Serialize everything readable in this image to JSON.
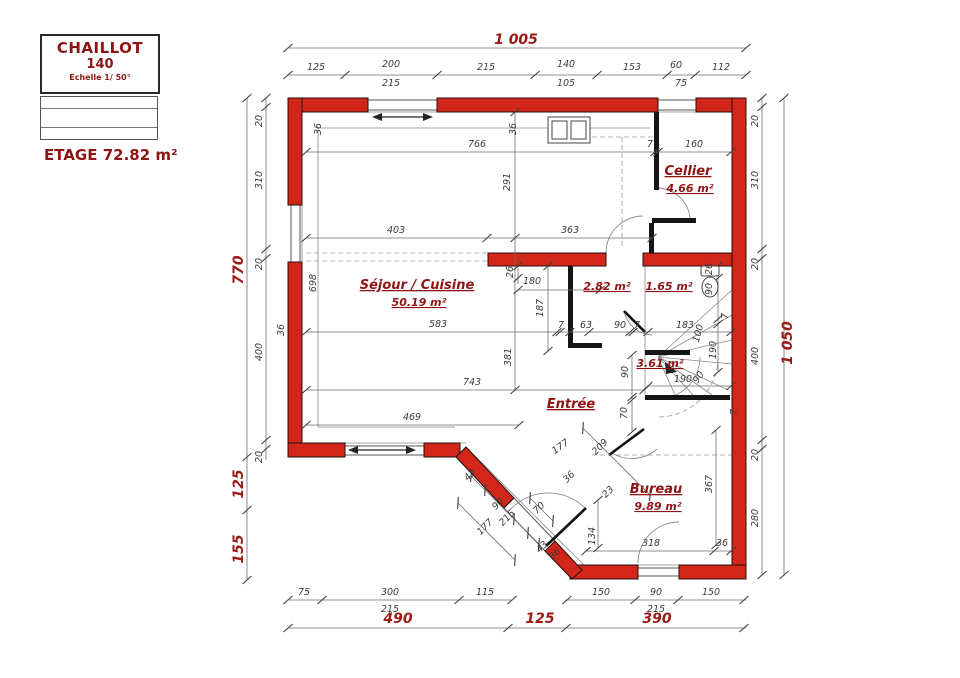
{
  "title_block": {
    "line1": "CHAILLOT",
    "line2": "140",
    "line3": "Echelle 1/ 50°"
  },
  "floor_area_label": "ETAGE 72.82 m²",
  "colors": {
    "wall_red": "#d2261a",
    "accent_text": "#8e1414",
    "dim_text": "#3a3a3a"
  },
  "rooms": [
    {
      "name": "Séjour / Cuisine",
      "area": "50.19 m²",
      "x": 417,
      "y": 289
    },
    {
      "name": "Cellier",
      "area": "4.66 m²",
      "x": 688,
      "y": 175
    },
    {
      "name": "Entrée",
      "area": "",
      "x": 571,
      "y": 408
    },
    {
      "name": "Bureau",
      "area": "9.89 m²",
      "x": 656,
      "y": 493
    },
    {
      "name": "",
      "area": "2.82 m²",
      "x": 607,
      "y": 290
    },
    {
      "name": "",
      "area": "1.65 m²",
      "x": 669,
      "y": 290
    },
    {
      "name": "",
      "area": "3.61 m²",
      "x": 660,
      "y": 367
    }
  ],
  "dimensions": {
    "overall": {
      "width": "1 005",
      "height_left": "770",
      "height_right": "1 050"
    },
    "labels": [
      {
        "t": "1 005",
        "x": 516,
        "y": 44,
        "c": "r"
      },
      {
        "t": "125",
        "x": 316,
        "y": 70
      },
      {
        "t": "200",
        "x": 391,
        "y": 67
      },
      {
        "t": "215",
        "x": 391,
        "y": 86
      },
      {
        "t": "215",
        "x": 486,
        "y": 70
      },
      {
        "t": "140",
        "x": 566,
        "y": 67
      },
      {
        "t": "105",
        "x": 566,
        "y": 86
      },
      {
        "t": "153",
        "x": 632,
        "y": 70
      },
      {
        "t": "60",
        "x": 676,
        "y": 68
      },
      {
        "t": "75",
        "x": 681,
        "y": 86
      },
      {
        "t": "112",
        "x": 721,
        "y": 70
      },
      {
        "t": "770",
        "x": 243,
        "y": 270,
        "r": -90,
        "c": "r"
      },
      {
        "t": "125",
        "x": 243,
        "y": 484,
        "r": -90,
        "c": "r"
      },
      {
        "t": "155",
        "x": 243,
        "y": 549,
        "r": -90,
        "c": "r"
      },
      {
        "t": "20",
        "x": 262,
        "y": 121,
        "r": -90
      },
      {
        "t": "310",
        "x": 262,
        "y": 180,
        "r": -90
      },
      {
        "t": "20",
        "x": 262,
        "y": 264,
        "r": -90
      },
      {
        "t": "400",
        "x": 262,
        "y": 352,
        "r": -90
      },
      {
        "t": "20",
        "x": 262,
        "y": 457,
        "r": -90
      },
      {
        "t": "20",
        "x": 758,
        "y": 121,
        "r": -90
      },
      {
        "t": "310",
        "x": 758,
        "y": 180,
        "r": -90
      },
      {
        "t": "20",
        "x": 758,
        "y": 264,
        "r": -90
      },
      {
        "t": "400",
        "x": 758,
        "y": 356,
        "r": -90
      },
      {
        "t": "20",
        "x": 758,
        "y": 455,
        "r": -90
      },
      {
        "t": "280",
        "x": 758,
        "y": 518,
        "r": -90
      },
      {
        "t": "1 050",
        "x": 792,
        "y": 343,
        "r": -90,
        "c": "r"
      },
      {
        "t": "75",
        "x": 304,
        "y": 595
      },
      {
        "t": "300",
        "x": 390,
        "y": 595
      },
      {
        "t": "215",
        "x": 390,
        "y": 612
      },
      {
        "t": "115",
        "x": 485,
        "y": 595
      },
      {
        "t": "150",
        "x": 601,
        "y": 595
      },
      {
        "t": "90",
        "x": 656,
        "y": 595
      },
      {
        "t": "215",
        "x": 656,
        "y": 612
      },
      {
        "t": "150",
        "x": 711,
        "y": 595
      },
      {
        "t": "490",
        "x": 398,
        "y": 623,
        "c": "r"
      },
      {
        "t": "125",
        "x": 540,
        "y": 623,
        "c": "r"
      },
      {
        "t": "390",
        "x": 657,
        "y": 623,
        "c": "r"
      },
      {
        "t": "36",
        "x": 321,
        "y": 129,
        "r": -90
      },
      {
        "t": "36",
        "x": 516,
        "y": 129,
        "r": -90
      },
      {
        "t": "766",
        "x": 477,
        "y": 147
      },
      {
        "t": "7",
        "x": 650,
        "y": 147
      },
      {
        "t": "160",
        "x": 694,
        "y": 147
      },
      {
        "t": "291",
        "x": 510,
        "y": 182,
        "r": -90
      },
      {
        "t": "698",
        "x": 316,
        "y": 283,
        "r": -90
      },
      {
        "t": "36",
        "x": 284,
        "y": 330,
        "r": -90
      },
      {
        "t": "403",
        "x": 396,
        "y": 233
      },
      {
        "t": "363",
        "x": 570,
        "y": 233
      },
      {
        "t": "26",
        "x": 513,
        "y": 272,
        "r": -90
      },
      {
        "t": "180",
        "x": 532,
        "y": 284
      },
      {
        "t": "187",
        "x": 543,
        "y": 308,
        "r": -90
      },
      {
        "t": "26",
        "x": 712,
        "y": 269,
        "r": -90
      },
      {
        "t": "90",
        "x": 712,
        "y": 289,
        "r": -90
      },
      {
        "t": "583",
        "x": 438,
        "y": 327
      },
      {
        "t": "7",
        "x": 561,
        "y": 328
      },
      {
        "t": "63",
        "x": 586,
        "y": 328
      },
      {
        "t": "90",
        "x": 620,
        "y": 328
      },
      {
        "t": "7",
        "x": 637,
        "y": 328
      },
      {
        "t": "183",
        "x": 685,
        "y": 328
      },
      {
        "t": "100",
        "x": 701,
        "y": 334,
        "r": -75
      },
      {
        "t": "190",
        "x": 716,
        "y": 350,
        "r": -90
      },
      {
        "t": "90",
        "x": 628,
        "y": 372,
        "r": -90
      },
      {
        "t": "190",
        "x": 683,
        "y": 382
      },
      {
        "t": "90",
        "x": 701,
        "y": 379,
        "r": -55
      },
      {
        "t": "7",
        "x": 728,
        "y": 316,
        "r": -90
      },
      {
        "t": "381",
        "x": 511,
        "y": 357,
        "r": -90
      },
      {
        "t": "743",
        "x": 472,
        "y": 385
      },
      {
        "t": "469",
        "x": 412,
        "y": 420
      },
      {
        "t": "70",
        "x": 627,
        "y": 413,
        "r": -90
      },
      {
        "t": "7",
        "x": 737,
        "y": 412,
        "r": -90
      },
      {
        "t": "367",
        "x": 712,
        "y": 484,
        "r": -90
      },
      {
        "t": "318",
        "x": 651,
        "y": 546
      },
      {
        "t": "36",
        "x": 722,
        "y": 546
      },
      {
        "t": "43",
        "x": 472,
        "y": 477,
        "r": -45
      },
      {
        "t": "90",
        "x": 500,
        "y": 506,
        "r": -45
      },
      {
        "t": "215",
        "x": 509,
        "y": 520,
        "r": -45
      },
      {
        "t": "177",
        "x": 487,
        "y": 529,
        "r": -45
      },
      {
        "t": "70",
        "x": 541,
        "y": 510,
        "r": -45
      },
      {
        "t": "43",
        "x": 544,
        "y": 549,
        "r": -45
      },
      {
        "t": "36",
        "x": 557,
        "y": 556,
        "r": -45
      },
      {
        "t": "36",
        "x": 571,
        "y": 479,
        "r": -45
      },
      {
        "t": "177",
        "x": 562,
        "y": 449,
        "r": -35
      },
      {
        "t": "209",
        "x": 602,
        "y": 449,
        "r": -45
      },
      {
        "t": "23",
        "x": 610,
        "y": 494,
        "r": -45
      },
      {
        "t": "134",
        "x": 595,
        "y": 536,
        "r": -90
      }
    ]
  }
}
